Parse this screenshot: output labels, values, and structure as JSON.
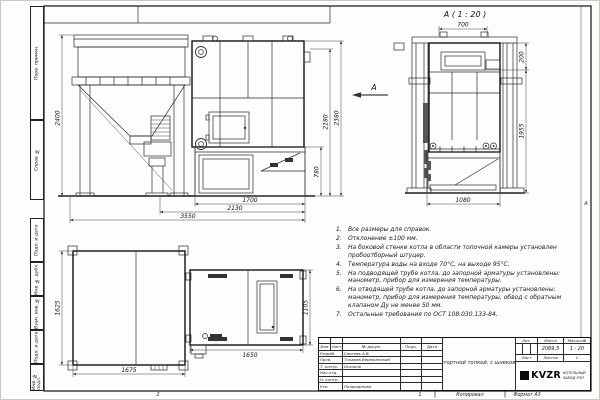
{
  "margin": {
    "copied": "Копировал",
    "format": "Формат А3",
    "zone_bottom_left": "2",
    "zone_bottom_right": "1",
    "zone_right": "А"
  },
  "side_strip": {
    "labels": [
      "Перв. примен.",
      "Справ. №",
      "Подп. и дата",
      "Инв. № дубл.",
      "Взам. инв. №",
      "Подп. и дата",
      "Инв. № подл."
    ]
  },
  "views": {
    "front": {
      "view_arrow_label": "А",
      "dim_bunker_height": "2400",
      "dim_total_height": "2380",
      "dim_body_height": "2180",
      "dim_firebox_height": "780",
      "dim_firebox_width": "1700",
      "dim_boiler_width": "2130",
      "dim_overall_width": "3550"
    },
    "side": {
      "title": "А ( 1 : 20 )",
      "dim_top_width": "700",
      "dim_collar_height": "200",
      "dim_body_height": "1955",
      "dim_bottom_width": "1080"
    },
    "plan": {
      "dim_bunker_depth": "1625",
      "dim_bunker_width": "1675",
      "dim_boiler_width": "1650",
      "dim_boiler_depth": "1105"
    }
  },
  "notes": [
    {
      "num": "1.",
      "text": "Все размеры для справок."
    },
    {
      "num": "2.",
      "text": "Отклонение ±100 мм."
    },
    {
      "num": "3.",
      "text": "На боковой стенке котла в области топочной камеры установлен пробоотборный штуцер."
    },
    {
      "num": "4.",
      "text": "Температура воды на входе 70°С, на выходе 95°С."
    },
    {
      "num": "5.",
      "text": "На подводящей трубе котла, до запорной арматуры установлены: манометр, прибор для измерения температуры."
    },
    {
      "num": "6.",
      "text": "На отводящей трубе котла, до запорной арматуры установлены: манометр, прибор для измерения температуры, обвод с обратным клапаном Ду не менее 50 мм."
    },
    {
      "num": "7.",
      "text": "Остальные требования по ОСТ 108.030.133-84."
    }
  ],
  "title_block": {
    "header": [
      "Изм",
      "Лист",
      "№ докум.",
      "Подп.",
      "Дата"
    ],
    "rows": [
      {
        "role": "Разраб.",
        "name": "Сергеев А.В."
      },
      {
        "role": "Пров.",
        "name": "Токарев-Вережанский"
      },
      {
        "role": "Т. контр.",
        "name": "Осачков"
      },
      {
        "role": "Нач.отд.",
        "name": ""
      },
      {
        "role": "Н. контр.",
        "name": ""
      },
      {
        "role": "Утв.",
        "name": "Поликарпова"
      }
    ],
    "title": "Котел КВм-0,6 КБД (с ретортной топкой, с шнековой подачей и бункером)",
    "lit_label": "Лит.",
    "mass_label": "Масса",
    "scale_label": "Масштаб",
    "mass": "2069,5",
    "scale": "1 : 20",
    "sheet_label": "Лист",
    "sheets_label": "Листов",
    "sheets_value": "1",
    "logo_text": "KVZR",
    "company_line1": "КОТЕЛЬНЫЙ",
    "company_line2": "ЗАВОД РЭП"
  }
}
